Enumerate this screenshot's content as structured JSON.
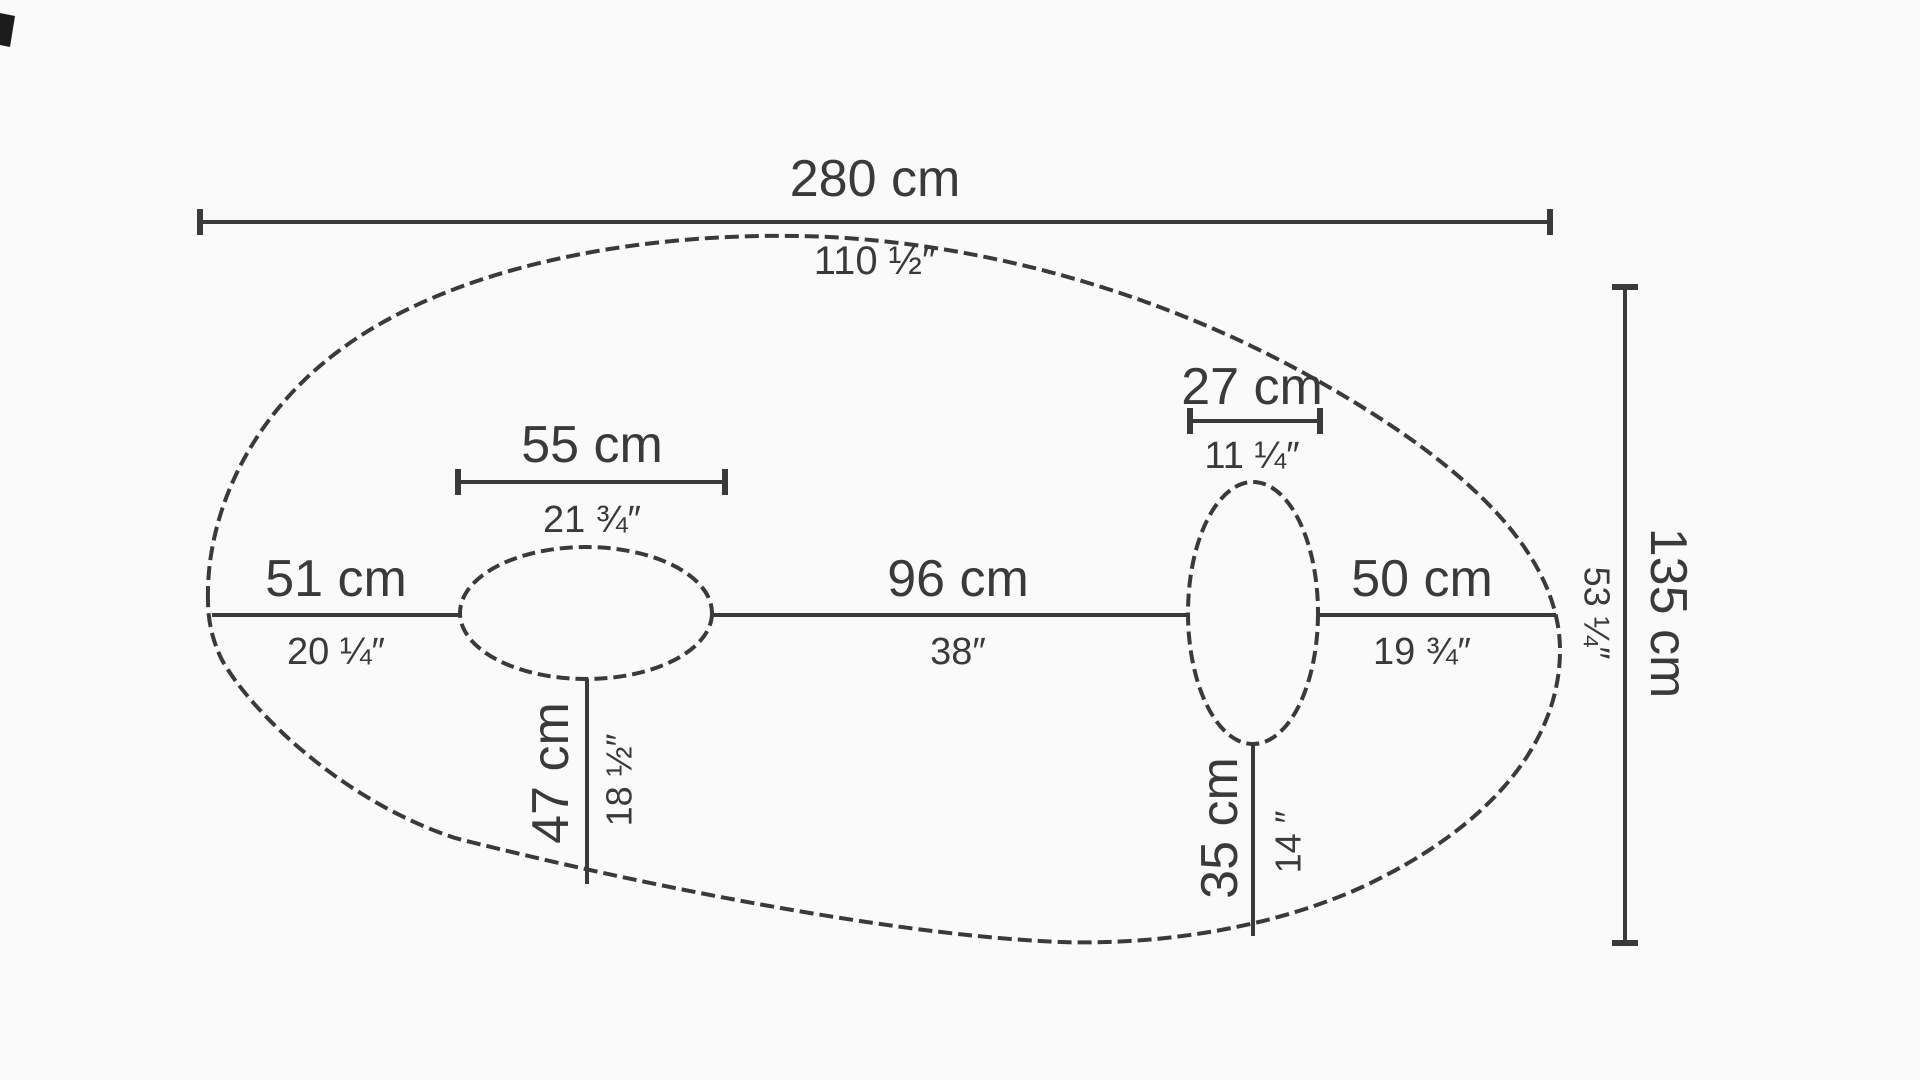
{
  "colors": {
    "background": "#fafafa",
    "line": "#3a3a3a",
    "text": "#3a3a3a"
  },
  "diagram": {
    "shape": "organic-oval-panel-with-two-oval-openings",
    "dimensions": {
      "overall_width": {
        "cm": "280 cm",
        "in": "110 ½″"
      },
      "overall_height": {
        "cm": "135 cm",
        "in": "53 ¼″"
      },
      "left_segment": {
        "cm": "51 cm",
        "in": "20 ¼″"
      },
      "left_opening_width": {
        "cm": "55 cm",
        "in": "21 ¾″"
      },
      "middle_segment": {
        "cm": "96 cm",
        "in": "38″"
      },
      "right_opening_width": {
        "cm": "27 cm",
        "in": "11 ¼″"
      },
      "right_segment": {
        "cm": "50 cm",
        "in": "19 ¾″"
      },
      "left_opening_depth": {
        "cm": "47 cm",
        "in": "18 ½″"
      },
      "right_opening_depth": {
        "cm": "35 cm",
        "in": "14 ″"
      }
    }
  }
}
